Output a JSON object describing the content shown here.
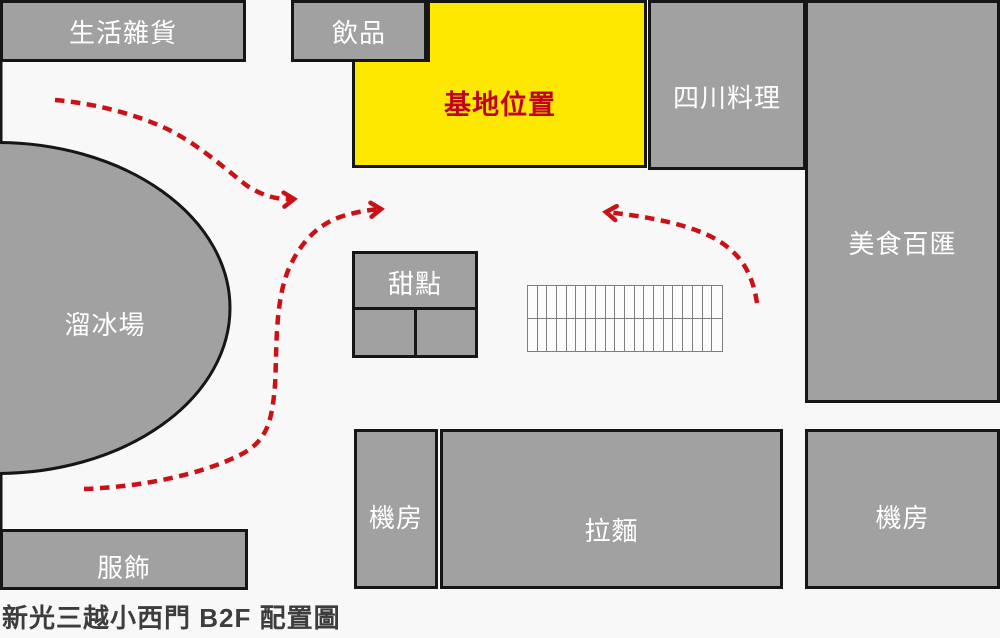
{
  "title": "新光三越小西門 B2F 配置圖",
  "colors": {
    "background": "#f8f8f8",
    "block_gray": "#a1a1a1",
    "border_black": "#161616",
    "highlight_yellow": "#ffe800",
    "highlight_text_red": "#c00321",
    "arrow_red": "#cb1016",
    "label_white": "#ffffff",
    "title_gray": "#3d3d3d",
    "grid_stroke": "#7e7e7e"
  },
  "areas": {
    "lifestyle_goods": {
      "label": "生活雜貨"
    },
    "drinks": {
      "label": "飲品"
    },
    "site_location": {
      "label": "基地位置",
      "highlighted": true
    },
    "sichuan_cuisine": {
      "label": "四川料理"
    },
    "food_court": {
      "label": "美食百匯"
    },
    "ice_rink": {
      "label": "溜冰場"
    },
    "dessert": {
      "label": "甜點"
    },
    "machine_room_left": {
      "label": "機房"
    },
    "ramen": {
      "label": "拉麵"
    },
    "machine_room_right": {
      "label": "機房"
    },
    "clothing": {
      "label": "服飾"
    }
  },
  "hatched_area": {
    "columns": 20,
    "rows": 2
  },
  "flow_arrows": [
    {
      "name": "upper-left-to-center",
      "d": "M 55 100 C 90 103, 130 112, 165 128 C 195 142, 222 166, 246 185 C 262 196, 278 200, 294 199"
    },
    {
      "name": "lower-left-around-rink-to-center",
      "d": "M 84 489 C 140 487, 200 475, 240 455 C 268 441, 272 420, 275 385 C 277 355, 274 300, 290 266 C 302 241, 318 225, 340 217 C 355 212, 368 210, 381 209"
    },
    {
      "name": "right-to-center",
      "d": "M 757 303 C 753 277, 744 258, 722 243 C 700 228, 662 218, 606 212"
    }
  ]
}
